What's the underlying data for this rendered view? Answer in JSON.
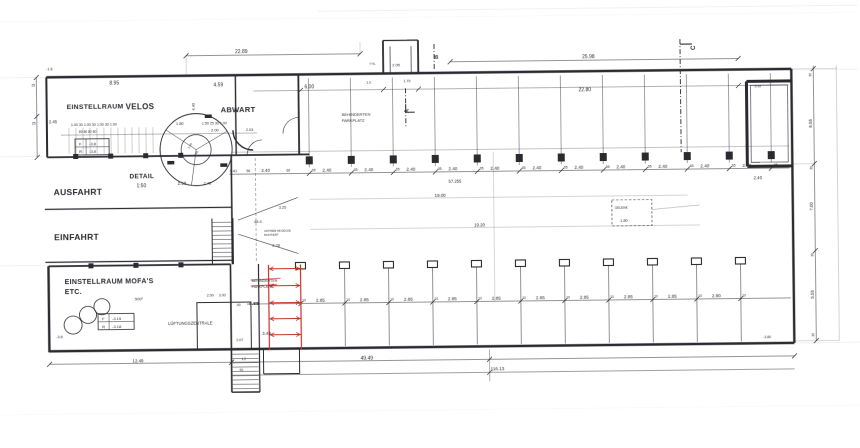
{
  "colors": {
    "ink": "#2a2a30",
    "red": "#c2342a",
    "faint": "#aab0bc"
  },
  "rooms": {
    "einstellraum": "EINSTELLRAUM",
    "velos": "VELOS",
    "abwart": "ABWART",
    "ausfahrt": "AUSFAHRT",
    "einfahrt": "EINFAHRT",
    "mofas1": "EINSTELLRAUM MOFA'S",
    "mofas2": "ETC.",
    "lueftung": "LÜFTUNGSZENTRALE"
  },
  "detail": {
    "title": "DETAIL",
    "scale": "1:50",
    "d1": "2.50",
    "d2": "2.45"
  },
  "behinderten_top": {
    "l1": "BEHINDERTEN",
    "l2": "PARKPLATZ"
  },
  "red_zone": {
    "l1": "BEHINDERTEN",
    "l2": "PARKPLATZ",
    "bay": "4.88",
    "stall": "3.48"
  },
  "markers": {
    "a": "A",
    "b": "B",
    "c": "C"
  },
  "levels": {
    "vf": "F",
    "vfv": "-3.8",
    "vr": "R",
    "vrv": "-3.8",
    "mf": "F",
    "mfv": "-3.15",
    "mr": "R",
    "mrv": "-3.18"
  },
  "levels_misc": {
    "ramp": "-1.8",
    "mofas": "-3.8",
    "right_top": "-3.52",
    "right_bot": "-3.80"
  },
  "dims": {
    "top_left": "22.89",
    "top_right": "25.98",
    "velos_w": "8.95",
    "velos_side": "2.45",
    "abwart_w": "4.59",
    "abwart_h": "4.40",
    "rack_chain": "1.00 30 1.00 30 1.00 30 1.00",
    "rack_sub": "80   80   80   80",
    "c180": "1.80",
    "chain2": "1.50 25 30 1.00",
    "c200": "2.00",
    "c203": "2.03",
    "six": "6.00",
    "right_block": "22.80",
    "first1": "1.41",
    "first2": "56",
    "first3": "2.40",
    "first4": "65",
    "top_total": "57.255",
    "aisle1": "19.00",
    "aisle2": "19.20",
    "b4949": "49.49",
    "b11613": "116.13",
    "b1249": "12.49",
    "vest1": "2.05",
    "vest2": "1.79",
    "vest3": "1.0",
    "vest4": "Y.NL",
    "ramp1": "48.4",
    "ramp2": "3.25",
    "ramp3": "2.78",
    "st1": "2.00",
    "st2": "3.00",
    "st3": ".90",
    "st4": "2.07",
    "st5": "1.2",
    "st6": "90",
    "area": "500²",
    "r855": "8.55",
    "r700": "7.00",
    "r555": "5.55",
    "r30": "30",
    "r240": "2.40",
    "l25": "25",
    "top_bays": [
      "2.40",
      "2.40",
      "2.40",
      "2.40",
      "2.40",
      "2.40",
      "2.40",
      "2.40",
      "2.40",
      "2.40",
      "2.40"
    ],
    "top_col": "65",
    "bottom_bays": [
      "2.85",
      "2.85",
      "2.85",
      "2.85",
      "2.85",
      "2.85",
      "2.85",
      "2.85",
      "2.85",
      "2.80"
    ],
    "bottom_col": "10"
  },
  "annotations": {
    "antrieb1": "ANTRIEB AB DECKE",
    "antrieb2": "MONTIERT",
    "gelenk": "GELENK",
    "gelenk_dim": "1.80",
    "spiral1": "1.00",
    "spiral2": "2.00"
  }
}
